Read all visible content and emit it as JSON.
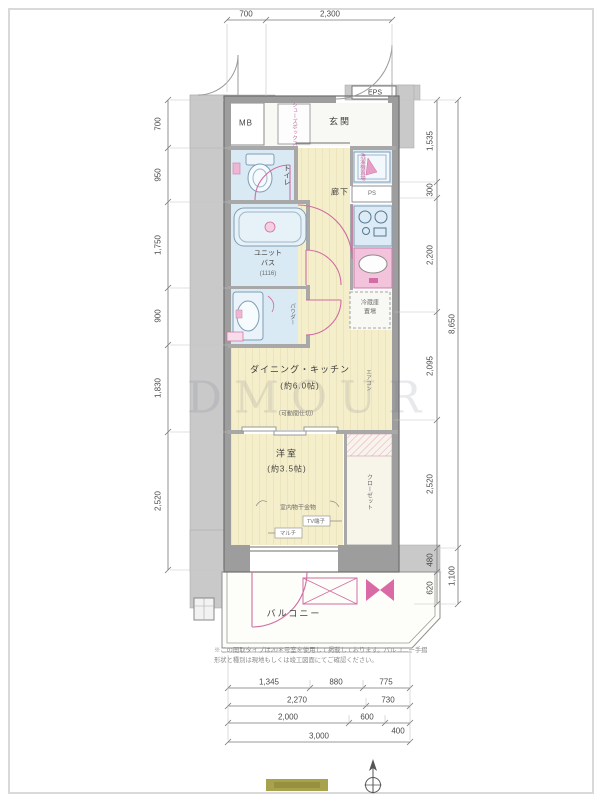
{
  "plan": {
    "rooms": {
      "eps": "EPS",
      "mb": "MB",
      "genkan": "玄関",
      "shoes": "シューズボックス",
      "toilet": "トイレ",
      "hall": "廊下",
      "washer": "洗濯機置場",
      "ps": "PS",
      "bath_l1": "ユニット",
      "bath_l2": "バス",
      "bath_l3": "(1116)",
      "powder": "パウダー",
      "fridge_l1": "冷蔵庫",
      "fridge_l2": "置場",
      "dk": "ダイニング・キッチン",
      "dk_size": "(約6.0帖)",
      "partition_note": "（可動間仕切）",
      "aircon": "エアコン",
      "bedroom": "洋室",
      "bedroom_size": "(約3.5帖)",
      "closet": "クローゼット",
      "laundry_hw": "室内物干金物",
      "tv": "TV端子",
      "multi": "マルチ",
      "balcony": "バルコニー"
    },
    "notes": {
      "line1": "※この間取タイプは20＊号室を使用して掲載しております。バルコニー手摺",
      "line2": "形状と種別は現地もしくは竣工図面にてご確認ください。"
    },
    "watermark": "DMOUR",
    "dims": {
      "top": [
        "700",
        "2,300"
      ],
      "left": [
        "700",
        "950",
        "1,750",
        "900",
        "1,830",
        "2,520"
      ],
      "right_inner": [
        "1,535",
        "300",
        "2,200",
        "2,095",
        "2,520",
        "480",
        "620"
      ],
      "right_outer": [
        "8,650",
        "1,100"
      ],
      "bottom_row1": [
        "1,345",
        "880",
        "775"
      ],
      "bottom_row2": [
        "2,270",
        "730"
      ],
      "bottom_row3": [
        "2,000",
        "600",
        "400"
      ],
      "bottom_row4": [
        "3,000"
      ]
    },
    "colors": {
      "floor": "#f5eeca",
      "wet": "#d9eaf4",
      "accent_pink": "#d06da2",
      "wall_gray": "#9d9d9d",
      "corridor_gray": "#c9c9c9",
      "logo_bar": "#a8a24c"
    }
  }
}
